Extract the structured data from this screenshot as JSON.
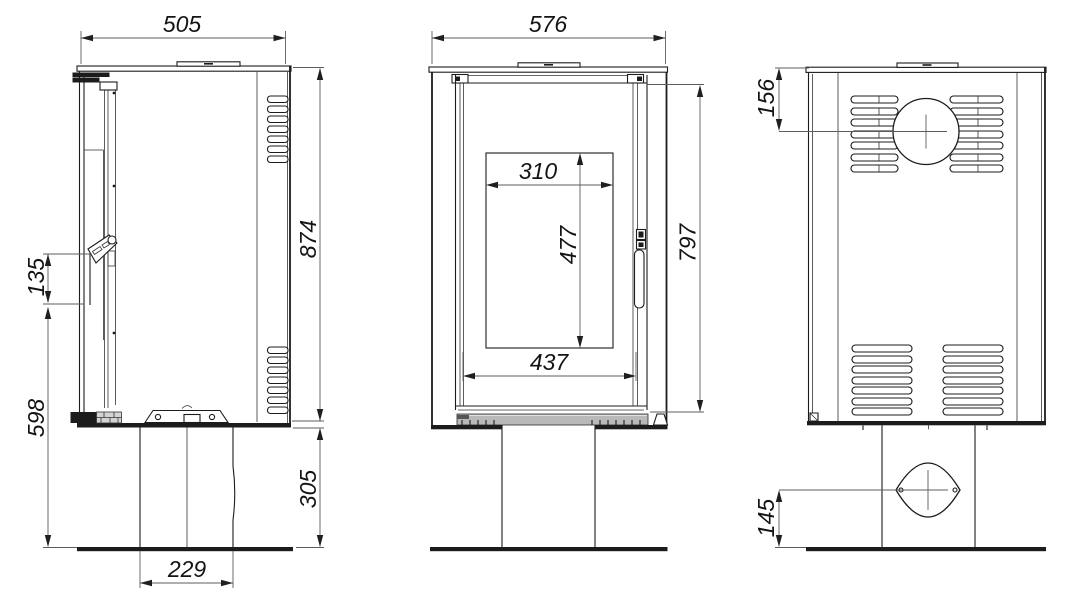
{
  "views": {
    "side": {
      "dims": {
        "overall_width": "505",
        "body_height": "874",
        "handle_length": "135",
        "handle_bottom_from_floor": "598",
        "base_height": "305",
        "pedestal_width": "229"
      }
    },
    "front": {
      "dims": {
        "overall_width": "576",
        "glass_width": "310",
        "glass_height": "477",
        "door_width": "437",
        "door_height": "797"
      }
    },
    "back": {
      "dims": {
        "flue_center_from_top": "156",
        "inlet_center_from_floor": "145"
      }
    }
  },
  "colors": {
    "line": "#1c1c1c",
    "dim_line": "#5c5c5c",
    "base_strip": "#b9b9b9",
    "background": "#ffffff"
  }
}
